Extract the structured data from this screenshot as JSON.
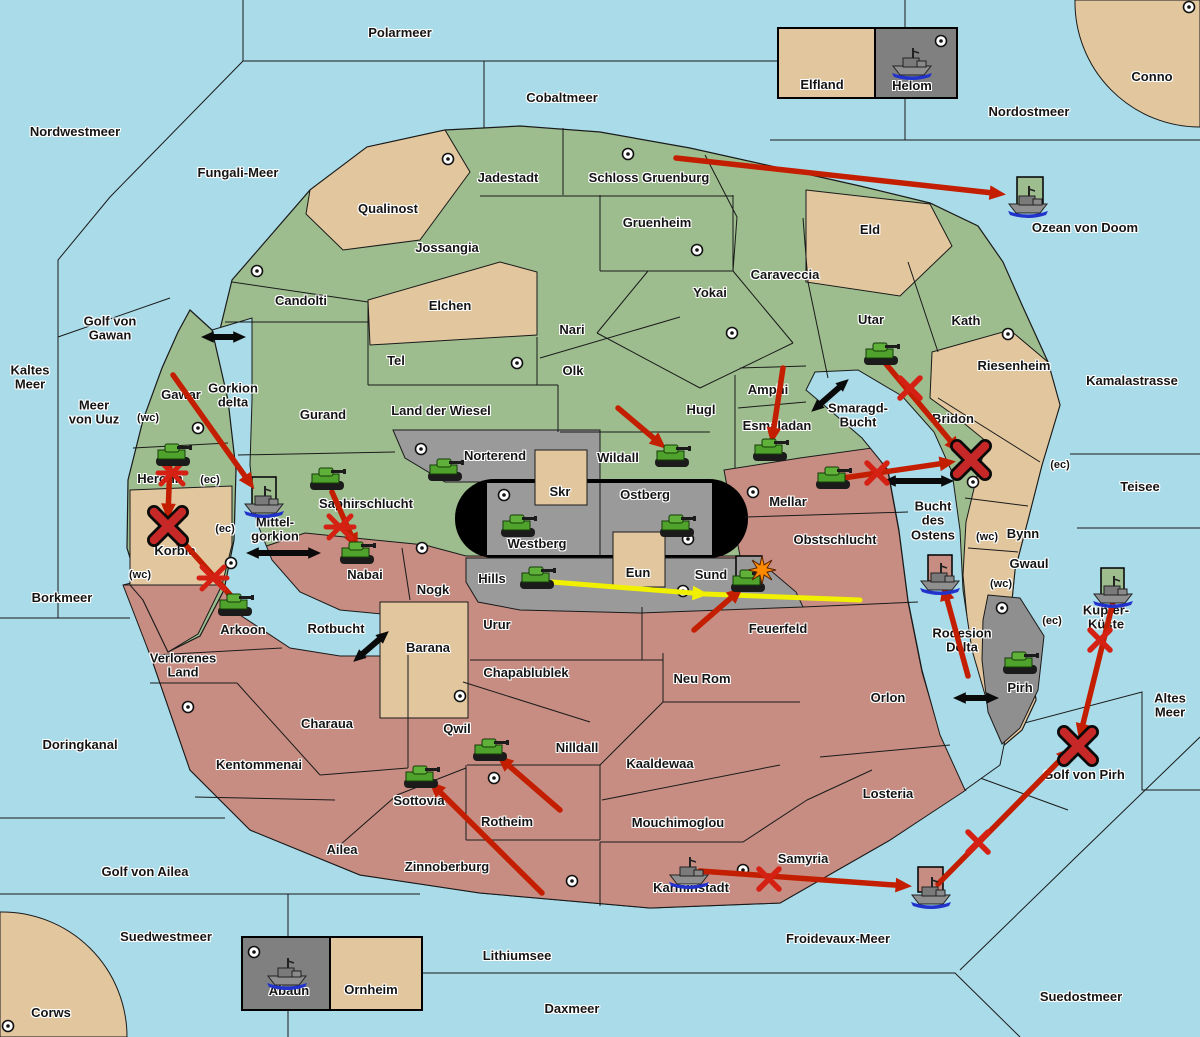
{
  "map": {
    "width": 1200,
    "height": 1037
  },
  "colors": {
    "sea": "#A9DBE8",
    "land_green": "#9DBD8E",
    "land_tan": "#E2C69E",
    "land_pink": "#C78D82",
    "land_gray": "#9A9A9A",
    "inset_gray": "#808080",
    "border": "#1A1A1A",
    "arrow_red": "#C41E00",
    "x_red": "#D42114",
    "x_big": "#C62828",
    "arrow_yellow": "#F0F000",
    "strait_black": "#0A0A0A",
    "army_green": "#4FA32C",
    "fleet_gray": "#8F8F8F",
    "explosion_orange": "#FF8A00",
    "box_green": "#9DBD8E",
    "box_pink": "#C78D82",
    "box_gray": "#9A9A9A"
  },
  "region_labels": [
    {
      "t": "Qualinost",
      "x": 388,
      "y": 209
    },
    {
      "t": "Jadestadt",
      "x": 508,
      "y": 178
    },
    {
      "t": "Schloss Gruenburg",
      "x": 649,
      "y": 178
    },
    {
      "t": "Gruenheim",
      "x": 657,
      "y": 223
    },
    {
      "t": "Jossangia",
      "x": 447,
      "y": 248
    },
    {
      "t": "Candolti",
      "x": 301,
      "y": 301
    },
    {
      "t": "Elchen",
      "x": 450,
      "y": 306
    },
    {
      "t": "Nari",
      "x": 572,
      "y": 330
    },
    {
      "t": "Tel",
      "x": 396,
      "y": 361
    },
    {
      "t": "Olk",
      "x": 573,
      "y": 371
    },
    {
      "t": "Yokai",
      "x": 710,
      "y": 293
    },
    {
      "t": "Caraveccia",
      "x": 785,
      "y": 275
    },
    {
      "t": "Eld",
      "x": 870,
      "y": 230
    },
    {
      "t": "Utar",
      "x": 871,
      "y": 320
    },
    {
      "t": "Kath",
      "x": 966,
      "y": 321
    },
    {
      "t": "Riesenheim",
      "x": 1014,
      "y": 366
    },
    {
      "t": "Gurand",
      "x": 323,
      "y": 415
    },
    {
      "t": "Land der Wiesel",
      "x": 441,
      "y": 411
    },
    {
      "t": "Hugl",
      "x": 701,
      "y": 410
    },
    {
      "t": "Amphi",
      "x": 768,
      "y": 390
    },
    {
      "t": "Esmaladan",
      "x": 777,
      "y": 426
    },
    {
      "t": "Wildall",
      "x": 618,
      "y": 458
    },
    {
      "t": "Gawar",
      "x": 181,
      "y": 395
    },
    {
      "t": "Heronn",
      "x": 160,
      "y": 479
    },
    {
      "t": "Korbia",
      "x": 175,
      "y": 551
    },
    {
      "t": "Saphirschlucht",
      "x": 366,
      "y": 504
    },
    {
      "t": "Nabai",
      "x": 365,
      "y": 575
    },
    {
      "t": "Norterend",
      "x": 495,
      "y": 456
    },
    {
      "t": "Skr",
      "x": 560,
      "y": 492
    },
    {
      "t": "Ostberg",
      "x": 645,
      "y": 495
    },
    {
      "t": "Westberg",
      "x": 537,
      "y": 544
    },
    {
      "t": "Mellar",
      "x": 788,
      "y": 502
    },
    {
      "t": "Obstschlucht",
      "x": 835,
      "y": 540
    },
    {
      "t": "Hills",
      "x": 492,
      "y": 579
    },
    {
      "t": "Eun",
      "x": 638,
      "y": 573
    },
    {
      "t": "Sund",
      "x": 711,
      "y": 575
    },
    {
      "t": "Nogk",
      "x": 433,
      "y": 590
    },
    {
      "t": "Urur",
      "x": 497,
      "y": 625
    },
    {
      "t": "Barana",
      "x": 428,
      "y": 648
    },
    {
      "t": "Bridon",
      "x": 953,
      "y": 419
    },
    {
      "t": "Bynn",
      "x": 1023,
      "y": 534
    },
    {
      "t": "Gwaul",
      "x": 1029,
      "y": 564
    },
    {
      "t": "Pirh",
      "x": 1020,
      "y": 688
    },
    {
      "t": "Arkoon",
      "x": 243,
      "y": 630
    },
    {
      "t": "Verlorenes\nLand",
      "x": 183,
      "y": 666
    },
    {
      "t": "Kentommenai",
      "x": 259,
      "y": 765
    },
    {
      "t": "Charaua",
      "x": 327,
      "y": 724
    },
    {
      "t": "Chapablublek",
      "x": 526,
      "y": 673
    },
    {
      "t": "Qwil",
      "x": 457,
      "y": 729
    },
    {
      "t": "Nilldall",
      "x": 577,
      "y": 748
    },
    {
      "t": "Kaaldewaa",
      "x": 660,
      "y": 764
    },
    {
      "t": "Neu Rom",
      "x": 702,
      "y": 679
    },
    {
      "t": "Feuerfeld",
      "x": 778,
      "y": 629
    },
    {
      "t": "Orlon",
      "x": 888,
      "y": 698
    },
    {
      "t": "Losteria",
      "x": 888,
      "y": 794
    },
    {
      "t": "Mouchimoglou",
      "x": 678,
      "y": 823
    },
    {
      "t": "Rotheim",
      "x": 507,
      "y": 822
    },
    {
      "t": "Sottovia",
      "x": 419,
      "y": 801
    },
    {
      "t": "Zinnoberburg",
      "x": 447,
      "y": 867
    },
    {
      "t": "Ailea",
      "x": 342,
      "y": 850
    },
    {
      "t": "Karminstadt",
      "x": 691,
      "y": 888
    },
    {
      "t": "Samyria",
      "x": 803,
      "y": 859
    },
    {
      "t": "Elfland",
      "x": 822,
      "y": 85
    },
    {
      "t": "Helom",
      "x": 912,
      "y": 86
    },
    {
      "t": "Abaun",
      "x": 289,
      "y": 991
    },
    {
      "t": "Ornheim",
      "x": 371,
      "y": 990
    },
    {
      "t": "Conno",
      "x": 1152,
      "y": 77
    },
    {
      "t": "Corws",
      "x": 51,
      "y": 1013
    }
  ],
  "sea_labels": [
    {
      "t": "Polarmeer",
      "x": 400,
      "y": 33
    },
    {
      "t": "Nordwestmeer",
      "x": 75,
      "y": 132
    },
    {
      "t": "Fungali-Meer",
      "x": 238,
      "y": 173
    },
    {
      "t": "Cobaltmeer",
      "x": 562,
      "y": 98
    },
    {
      "t": "Nordostmeer",
      "x": 1029,
      "y": 112
    },
    {
      "t": "Ozean von Doom",
      "x": 1085,
      "y": 228
    },
    {
      "t": "Kaltes\nMeer",
      "x": 30,
      "y": 378
    },
    {
      "t": "Golf von\nGawan",
      "x": 110,
      "y": 329
    },
    {
      "t": "Meer\nvon Uuz",
      "x": 94,
      "y": 413
    },
    {
      "t": "Gorkion\ndelta",
      "x": 233,
      "y": 396
    },
    {
      "t": "Mittel-\ngorkion",
      "x": 275,
      "y": 530
    },
    {
      "t": "Borkmeer",
      "x": 62,
      "y": 598
    },
    {
      "t": "Rotbucht",
      "x": 336,
      "y": 629
    },
    {
      "t": "Doringkanal",
      "x": 80,
      "y": 745
    },
    {
      "t": "Golf von Ailea",
      "x": 145,
      "y": 872
    },
    {
      "t": "Suedwestmeer",
      "x": 166,
      "y": 937
    },
    {
      "t": "Lithiumsee",
      "x": 517,
      "y": 956
    },
    {
      "t": "Daxmeer",
      "x": 572,
      "y": 1009
    },
    {
      "t": "Froidevaux-Meer",
      "x": 838,
      "y": 939
    },
    {
      "t": "Suedostmeer",
      "x": 1081,
      "y": 997
    },
    {
      "t": "Kamalastrasse",
      "x": 1132,
      "y": 381
    },
    {
      "t": "Teisee",
      "x": 1140,
      "y": 487
    },
    {
      "t": "Smaragd-\nBucht",
      "x": 858,
      "y": 416
    },
    {
      "t": "Bucht\ndes\nOstens",
      "x": 933,
      "y": 521
    },
    {
      "t": "Rodesion\nDelta",
      "x": 962,
      "y": 641
    },
    {
      "t": "Kupfer-\nKüste",
      "x": 1106,
      "y": 618
    },
    {
      "t": "Golf von Pirh",
      "x": 1084,
      "y": 775
    },
    {
      "t": "Altes\nMeer",
      "x": 1170,
      "y": 706
    }
  ],
  "coast_labels": [
    {
      "t": "(wc)",
      "x": 148,
      "y": 418
    },
    {
      "t": "(ec)",
      "x": 210,
      "y": 480
    },
    {
      "t": "(ec)",
      "x": 225,
      "y": 529
    },
    {
      "t": "(wc)",
      "x": 140,
      "y": 575
    },
    {
      "t": "(ec)",
      "x": 1060,
      "y": 465
    },
    {
      "t": "(wc)",
      "x": 987,
      "y": 537
    },
    {
      "t": "(wc)",
      "x": 1001,
      "y": 584
    },
    {
      "t": "(ec)",
      "x": 1052,
      "y": 621
    }
  ],
  "supply_centers": [
    [
      448,
      159
    ],
    [
      628,
      154
    ],
    [
      697,
      250
    ],
    [
      732,
      333
    ],
    [
      257,
      271
    ],
    [
      517,
      363
    ],
    [
      1008,
      334
    ],
    [
      198,
      428
    ],
    [
      973,
      482
    ],
    [
      421,
      449
    ],
    [
      504,
      495
    ],
    [
      688,
      539
    ],
    [
      753,
      492
    ],
    [
      683,
      591
    ],
    [
      422,
      548
    ],
    [
      231,
      563
    ],
    [
      188,
      707
    ],
    [
      460,
      696
    ],
    [
      494,
      778
    ],
    [
      572,
      881
    ],
    [
      743,
      870
    ],
    [
      1002,
      608
    ],
    [
      941,
      41
    ],
    [
      1189,
      7
    ],
    [
      8,
      1026
    ],
    [
      254,
      952
    ]
  ],
  "units": {
    "armies": [
      [
        173,
        455
      ],
      [
        327,
        479
      ],
      [
        357,
        553
      ],
      [
        235,
        605
      ],
      [
        445,
        470
      ],
      [
        518,
        526
      ],
      [
        677,
        526
      ],
      [
        672,
        456
      ],
      [
        770,
        450
      ],
      [
        833,
        478
      ],
      [
        881,
        354
      ],
      [
        537,
        578
      ],
      [
        748,
        581
      ],
      [
        490,
        750
      ],
      [
        421,
        777
      ],
      [
        1020,
        663
      ]
    ],
    "fleets": [
      [
        912,
        62
      ],
      [
        1028,
        200
      ],
      [
        264,
        500
      ],
      [
        940,
        577
      ],
      [
        1113,
        590
      ],
      [
        689,
        871
      ],
      [
        931,
        891
      ],
      [
        287,
        972
      ]
    ]
  },
  "unit_boxes": [
    {
      "x": 1017,
      "y": 177,
      "w": 26,
      "h": 31,
      "f": "box_green"
    },
    {
      "x": 252,
      "y": 477,
      "w": 24,
      "h": 30,
      "f": "box_green"
    },
    {
      "x": 928,
      "y": 555,
      "w": 24,
      "h": 26,
      "f": "box_pink"
    },
    {
      "x": 1101,
      "y": 568,
      "w": 23,
      "h": 28,
      "f": "box_green"
    },
    {
      "x": 918,
      "y": 867,
      "w": 25,
      "h": 25,
      "f": "box_pink"
    },
    {
      "x": 736,
      "y": 556,
      "w": 26,
      "h": 26,
      "f": "box_gray"
    }
  ],
  "red_arrows": [
    [
      676,
      158,
      1002,
      194
    ],
    [
      173,
      375,
      252,
      486
    ],
    [
      170,
      460,
      168,
      516
    ],
    [
      242,
      608,
      174,
      532
    ],
    [
      332,
      492,
      356,
      546
    ],
    [
      618,
      408,
      663,
      446
    ],
    [
      783,
      368,
      772,
      440
    ],
    [
      886,
      364,
      958,
      450
    ],
    [
      843,
      478,
      952,
      462
    ],
    [
      694,
      630,
      740,
      590
    ],
    [
      968,
      676,
      944,
      588
    ],
    [
      1113,
      602,
      1080,
      736
    ],
    [
      938,
      884,
      1070,
      750
    ],
    [
      700,
      871,
      908,
      886
    ],
    [
      560,
      810,
      500,
      758
    ],
    [
      542,
      893,
      432,
      784
    ]
  ],
  "yellow_arrows": [
    [
      552,
      582,
      705,
      594
    ]
  ],
  "yellow_lines": [
    [
      705,
      594,
      860,
      600
    ]
  ],
  "straits": [
    [
      210,
      337,
      237,
      337
    ],
    [
      255,
      553,
      312,
      553
    ],
    [
      360,
      656,
      382,
      637
    ],
    [
      818,
      406,
      842,
      385
    ],
    [
      892,
      481,
      945,
      481
    ],
    [
      962,
      698,
      990,
      698
    ]
  ],
  "x_small": [
    [
      910,
      388
    ],
    [
      877,
      473
    ],
    [
      769,
      879
    ],
    [
      978,
      842
    ],
    [
      1100,
      640
    ]
  ],
  "x_star": [
    [
      172,
      473
    ],
    [
      340,
      527
    ],
    [
      213,
      578
    ]
  ],
  "x_big": [
    [
      168,
      526
    ],
    [
      971,
      460
    ],
    [
      1078,
      746
    ]
  ],
  "explosions": [
    [
      762,
      570
    ]
  ]
}
